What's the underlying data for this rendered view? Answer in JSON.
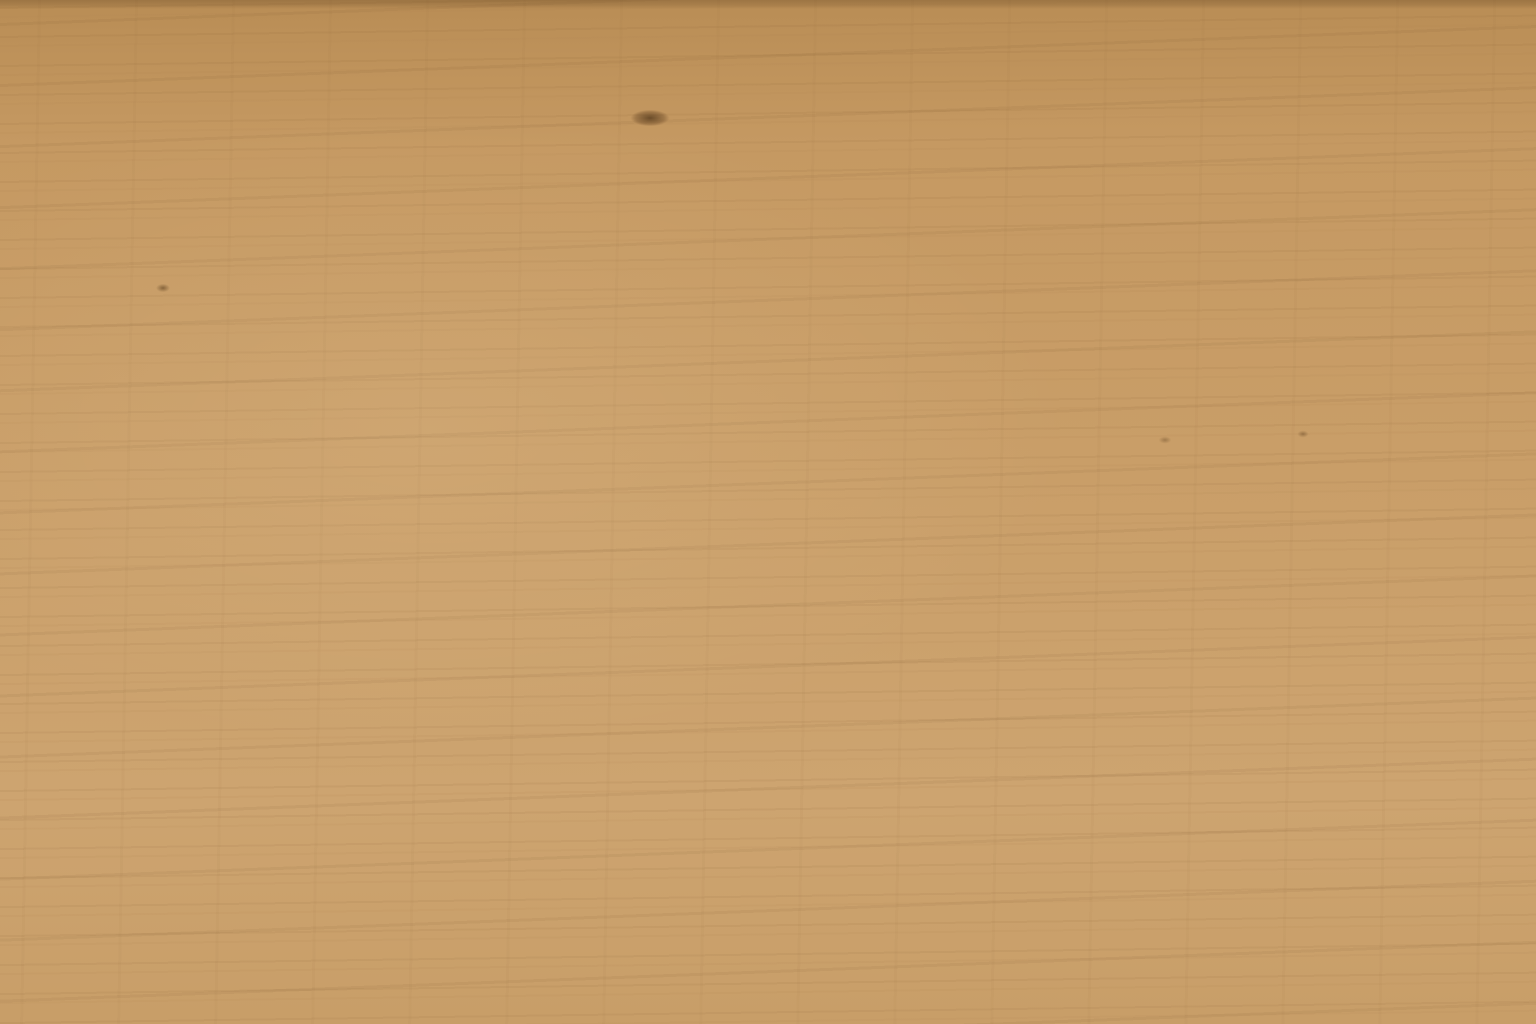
{
  "colors": {
    "wood": "#c69a63",
    "paper": "#f8f7f5",
    "template_gray": "#d9d7d7",
    "cut_line_red": "#c4646c",
    "brand_olive": "#7d8b2b",
    "badge_green": "#8da32f",
    "header_text": "#9c9a98",
    "footer_text": "#565450",
    "watermark": "#8f8a84"
  },
  "badge": {
    "icon": "fretsaw-icon"
  },
  "header": {
    "title": "LAUBSÄGEVORLAGE",
    "edition": "Ausgabe 45",
    "subtitle": "Sägevorlage (1:1) von FEINSCHNITTkreativ"
  },
  "logo": {
    "fein": "FEIN",
    "schnitt": "SCHNITT",
    "kreativ": "kreativ"
  },
  "watermark": {
    "text": "© 2025 www.feinschnitt-kreativ.de"
  },
  "footer": {
    "mark": "!",
    "line1": "© 2025 by Verlag Holger Graf, Hauptstraße 28, D-78247 Hilzingen · www.feinschnitt-kreativ.de",
    "line2": "Alle Vorlagen und Motive von FEINSCHNITTkreativ stehen unter Urheberschutz und sind nur für die private Verwendung vorgesehen. Nachdruck",
    "line3": "sowie jede Art von Vervielfältigung und Weitergabe sind untersagt. Gewerbliches Nacharbeiten ist nicht erlaubt, sofern keine Genehmigung vorliegt."
  },
  "under_sheets": {
    "sheet2_title": "LAUBSÄGEVORLAGE",
    "sheet3_title": "LAUBSÄGEVORLAGE"
  }
}
